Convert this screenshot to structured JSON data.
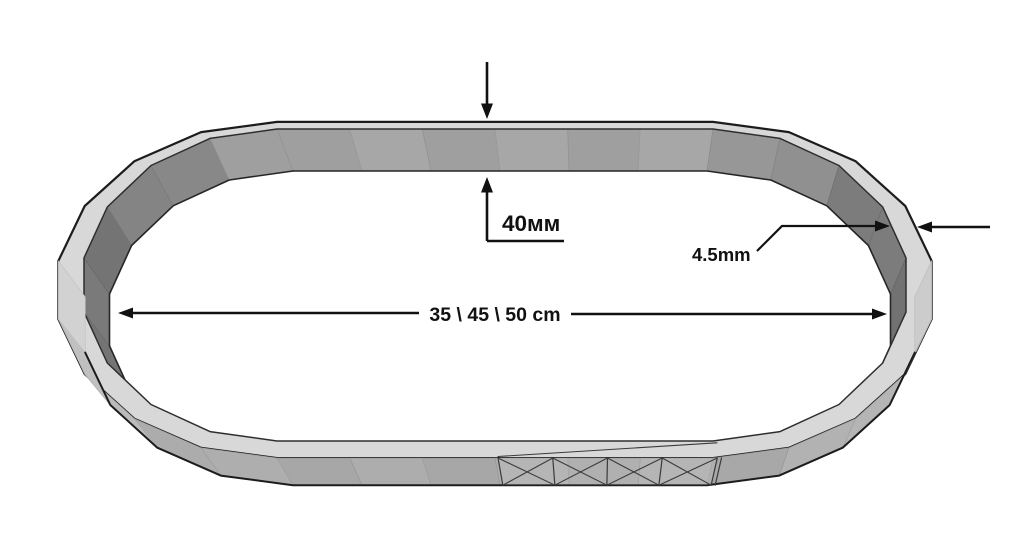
{
  "drawing": {
    "labels": {
      "band_height": "40мм",
      "wall_thickness": "4.5mm",
      "inner_length": "35 \\ 45 \\ 50 cm"
    },
    "colors": {
      "background": "#ffffff",
      "top_rim": "#d8d8d8",
      "outer_wall": "#ababab",
      "outer_wall_ends": "#cfcfcf",
      "inner_wall": "#a3a3a3",
      "inner_wall_ends": "#757575",
      "outline": "#1c1c1c",
      "annotation": "#111111"
    }
  }
}
